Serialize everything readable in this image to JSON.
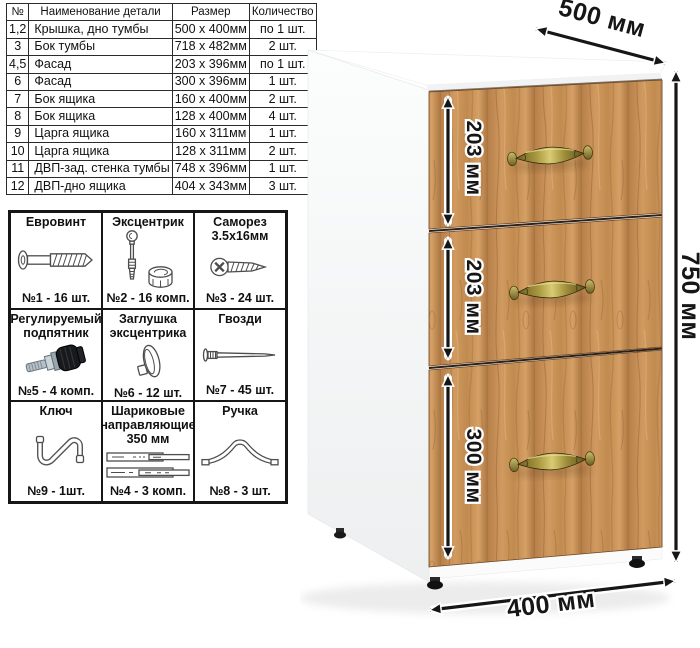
{
  "parts_table": {
    "headers": {
      "num": "№",
      "name": "Наименование детали",
      "size": "Размер",
      "qty": "Количество"
    },
    "rows": [
      {
        "num": "1,2",
        "name": "Крышка, дно тумбы",
        "size": "500 x 400мм",
        "qty": "по 1 шт."
      },
      {
        "num": "3",
        "name": "Бок тумбы",
        "size": "718 x 482мм",
        "qty": "2 шт."
      },
      {
        "num": "4,5",
        "name": "Фасад",
        "size": "203 x 396мм",
        "qty": "по 1 шт."
      },
      {
        "num": "6",
        "name": "Фасад",
        "size": "300 x 396мм",
        "qty": "1 шт."
      },
      {
        "num": "7",
        "name": "Бок ящика",
        "size": "160 x 400мм",
        "qty": "2 шт."
      },
      {
        "num": "8",
        "name": "Бок ящика",
        "size": "128 x 400мм",
        "qty": "4 шт."
      },
      {
        "num": "9",
        "name": "Царга ящика",
        "size": "160 x 311мм",
        "qty": "1 шт."
      },
      {
        "num": "10",
        "name": "Царга ящика",
        "size": "128 x 311мм",
        "qty": "2 шт."
      },
      {
        "num": "11",
        "name": "ДВП-зад. стенка тумбы",
        "size": "748 x 396мм",
        "qty": "1 шт."
      },
      {
        "num": "12",
        "name": "ДВП-дно ящика",
        "size": "404 x 343мм",
        "qty": "3 шт."
      }
    ]
  },
  "hardware": {
    "items": [
      {
        "title": "Евровинт",
        "icon": "euro-screw-icon",
        "count": "№1 - 16 шт."
      },
      {
        "title": "Эксцентрик",
        "icon": "cam-lock-icon",
        "count": "№2 - 16 комп."
      },
      {
        "title": "Саморез\n3.5х16мм",
        "icon": "self-tapping-screw-icon",
        "count": "№3 - 24 шт."
      },
      {
        "title": "Регулируемый\nподпятник",
        "icon": "adjustable-foot-icon",
        "count": "№5 - 4 комп."
      },
      {
        "title": "Заглушка\nэксцентрика",
        "icon": "cam-cover-icon",
        "count": "№6 - 12 шт."
      },
      {
        "title": "Гвозди",
        "icon": "nail-icon",
        "count": "№7 - 45 шт."
      },
      {
        "title": "Ключ",
        "icon": "key-icon",
        "count": "№9 - 1шт."
      },
      {
        "title": "Шариковые\nнаправляющие\n350 мм",
        "icon": "ball-bearing-slides-icon",
        "count": "№4 - 3 комп."
      },
      {
        "title": "Ручка",
        "icon": "bow-handle-icon",
        "count": "№8 - 3 шт."
      }
    ]
  },
  "diagram": {
    "dimensions": {
      "top_depth": "500 мм",
      "height": "750 мм",
      "width": "400 мм",
      "drawer1": "203 мм",
      "drawer2": "203 мм",
      "drawer3": "300 мм"
    },
    "colors": {
      "wood": "#c68e52",
      "wood_dark": "#7e5428",
      "wood_light": "#dcae74",
      "handle_brass": "#9c8d3a",
      "dimension_text": "#161616",
      "carcass_white": "#fafbfb"
    }
  }
}
